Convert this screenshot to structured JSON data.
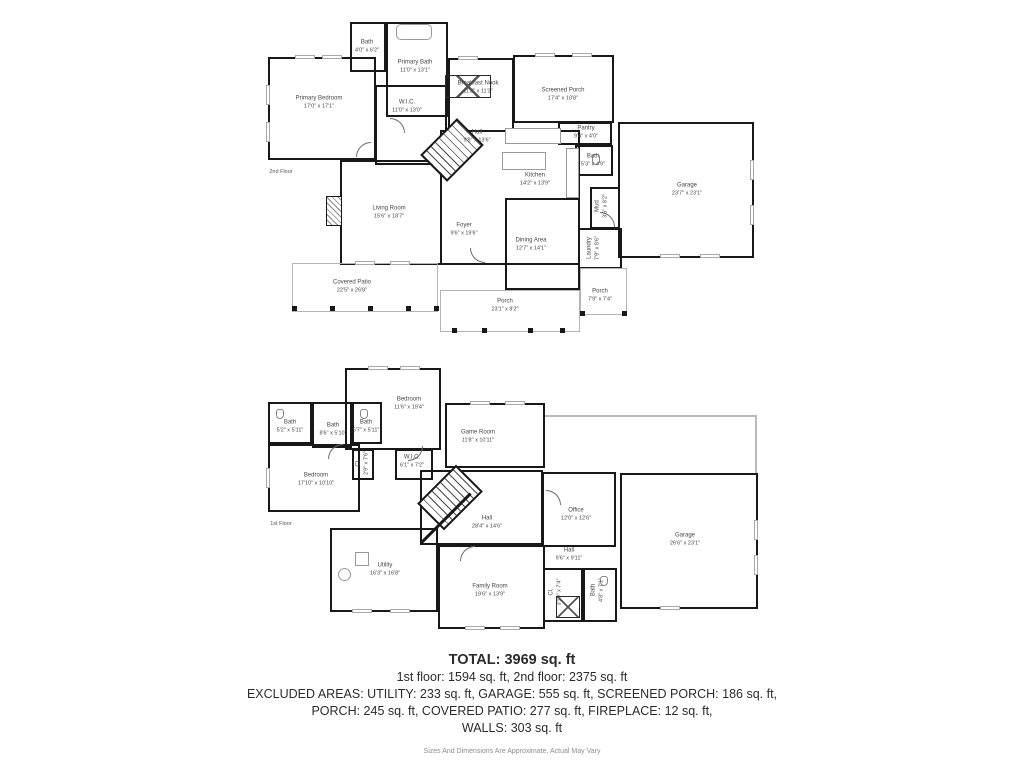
{
  "summary": {
    "total": "TOTAL: 3969 sq. ft",
    "floors_line": "1st floor: 1594 sq. ft, 2nd floor: 2375 sq. ft",
    "excluded_line1": "EXCLUDED AREAS: UTILITY: 233 sq. ft, GARAGE: 555 sq. ft, SCREENED PORCH: 186 sq. ft,",
    "excluded_line2": "PORCH: 245 sq. ft, COVERED PATIO: 277 sq. ft, FIREPLACE: 12 sq. ft,",
    "excluded_line3": "WALLS: 303 sq. ft",
    "disclaimer": "Sizes And Dimensions Are Approximate, Actual May Vary"
  },
  "floors": [
    {
      "label": "2nd Floor",
      "rooms": [
        {
          "name": "Bath",
          "dims": "4'0\" x 6'2\""
        },
        {
          "name": "Primary Bath",
          "dims": "11'0\" x 13'1\""
        },
        {
          "name": "Primary Bedroom",
          "dims": "17'0\" x 17'1\""
        },
        {
          "name": "W.I.C.",
          "dims": "11'0\" x 13'0\""
        },
        {
          "name": "Breakfast Nook",
          "dims": "11'8\" x 11'3\""
        },
        {
          "name": "Screened Porch",
          "dims": "17'4\" x 10'8\""
        },
        {
          "name": "Hall",
          "dims": "9'9\" x 13'6\""
        },
        {
          "name": "Pantry",
          "dims": "9'4\" x 4'0\""
        },
        {
          "name": "Bath",
          "dims": "5'3\" x 4'9\""
        },
        {
          "name": "Kitchen",
          "dims": "14'2\" x 13'9\""
        },
        {
          "name": "Garage",
          "dims": "23'7\" x 23'1\""
        },
        {
          "name": "Living Room",
          "dims": "15'6\" x 18'7\""
        },
        {
          "name": "Foyer",
          "dims": "9'6\" x 19'6\""
        },
        {
          "name": "Dining Area",
          "dims": "12'7\" x 14'1\""
        },
        {
          "name": "Mud",
          "dims": "3'6\" x 8'2\""
        },
        {
          "name": "Laundry",
          "dims": "7'9\" x 8'6\""
        },
        {
          "name": "Covered Patio",
          "dims": "22'5\" x 26'8\""
        },
        {
          "name": "Porch",
          "dims": "23'1\" x 8'2\""
        },
        {
          "name": "Porch",
          "dims": "7'9\" x 7'4\""
        }
      ]
    },
    {
      "label": "1st Floor",
      "rooms": [
        {
          "name": "Bath",
          "dims": "5'2\" x 5'11\""
        },
        {
          "name": "Bath",
          "dims": "8'6\" x 5'10\""
        },
        {
          "name": "Bath",
          "dims": "5'7\" x 5'11\""
        },
        {
          "name": "Bedroom",
          "dims": "11'6\" x 19'4\""
        },
        {
          "name": "Game Room",
          "dims": "11'8\" x 10'11\""
        },
        {
          "name": "Bedroom",
          "dims": "17'10\" x 10'10\""
        },
        {
          "name": "W.I.C.",
          "dims": "6'1\" x 7'2\""
        },
        {
          "name": "Cl.",
          "dims": "2'9\" x 7'6\""
        },
        {
          "name": "Hall",
          "dims": "28'4\" x 14'6\""
        },
        {
          "name": "Office",
          "dims": "12'0\" x 12'6\""
        },
        {
          "name": "Hall",
          "dims": "9'6\" x 9'11\""
        },
        {
          "name": "Garage",
          "dims": "26'6\" x 23'1\""
        },
        {
          "name": "Utility",
          "dims": "16'3\" x 16'8\""
        },
        {
          "name": "Family Room",
          "dims": "19'6\" x 13'9\""
        },
        {
          "name": "Cl.",
          "dims": "3'10\" x 7'4\""
        },
        {
          "name": "Bath",
          "dims": "4'8\" x 7'1\""
        }
      ]
    }
  ]
}
